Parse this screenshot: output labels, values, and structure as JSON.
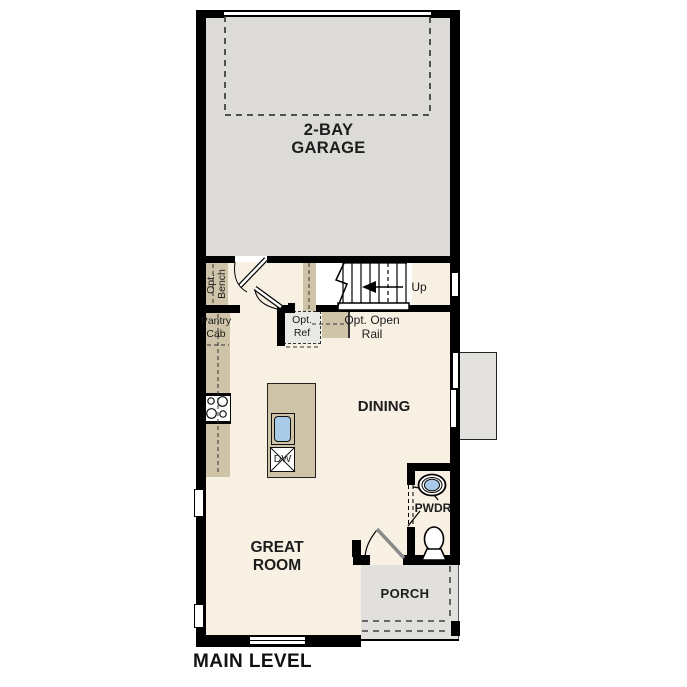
{
  "title": "MAIN LEVEL",
  "rooms": {
    "garage": {
      "name": "2-BAY\nGARAGE"
    },
    "dining": {
      "name": "DINING"
    },
    "great_room": {
      "name": "GREAT\nROOM"
    },
    "powder": {
      "name": "PWDR"
    },
    "porch": {
      "name": "PORCH"
    }
  },
  "labels": {
    "up": "Up",
    "opt_bench": "Opt.\nBench",
    "pantry_cab": "Pantry\nCab",
    "opt_ref": "Opt.\nRef",
    "opt_open_rail": "Opt. Open\nRail",
    "dishwasher": "DW"
  },
  "colors": {
    "walls": "#000000",
    "main_floor": "#f7f0e3",
    "garage_floor": "#dcdbd7",
    "porch_floor": "#e1e0dc",
    "stoop": "#e3e2df",
    "cabinet_tan": "#cfc3a8",
    "sink_blue": "#a9cbe7",
    "opt_ref_gray": "#e9e9e6",
    "door_leaf_gray": "#8a8a8a",
    "text": "#1c1c1c"
  }
}
